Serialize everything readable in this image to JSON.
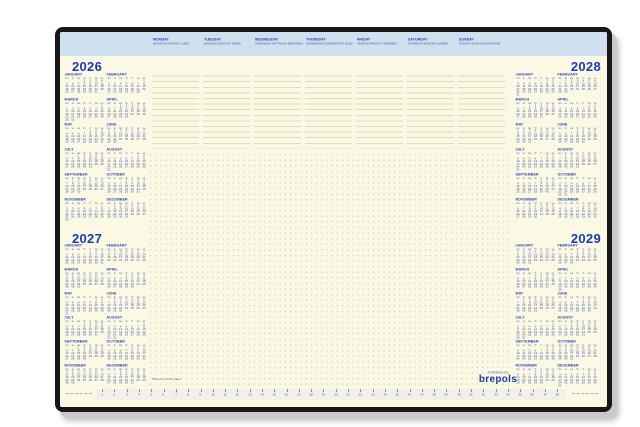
{
  "header": {
    "day_columns": [
      {
        "en": "MONDAY",
        "sub": "MAANDAG MONTAG LUNDI"
      },
      {
        "en": "TUESDAY",
        "sub": "DINSDAG DIENSTAG MARDI"
      },
      {
        "en": "WEDNESDAY",
        "sub": "WOENSDAG MITTWOCH MERCREDI"
      },
      {
        "en": "THURSDAY",
        "sub": "DONDERDAG DONNERSTAG JEUDI"
      },
      {
        "en": "FRIDAY",
        "sub": "VRIJDAG FREITAG VENDREDI"
      },
      {
        "en": "SATURDAY",
        "sub": "ZATERDAG SAMSTAG SAMEDI"
      },
      {
        "en": "SUNDAY",
        "sub": "ZONDAG SONNTAG DIMANCHE"
      }
    ]
  },
  "mini_calendar": {
    "weekday_header": [
      "mo",
      "tu",
      "we",
      "th",
      "fr",
      "sa",
      "su"
    ],
    "month_names": [
      "JANUARY",
      "FEBRUARY",
      "MARCH",
      "APRIL",
      "MAY",
      "JUNE",
      "JULY",
      "AUGUST",
      "SEPTEMBER",
      "OCTOBER",
      "NOVEMBER",
      "DECEMBER"
    ]
  },
  "year_blocks": [
    {
      "year": "2026",
      "side": "left",
      "row": "top"
    },
    {
      "year": "2027",
      "side": "left",
      "row": "bottom"
    },
    {
      "year": "2028",
      "side": "right",
      "row": "top"
    },
    {
      "year": "2029",
      "side": "right",
      "row": "bottom"
    }
  ],
  "footer": {
    "printed_note": "Printed on FSC paper",
    "published_by": "Published by",
    "brand": "brepols",
    "ruler_numbers": [
      1,
      2,
      3,
      4,
      5,
      6,
      7,
      8,
      9,
      10,
      11,
      12,
      13,
      14,
      15,
      16,
      17,
      18,
      19,
      20,
      21,
      22,
      23,
      24,
      25,
      26,
      27,
      28,
      29,
      30,
      31,
      32,
      33,
      34,
      35,
      36,
      37,
      38
    ]
  },
  "colors": {
    "accent_blue": "#1b3bb2",
    "text_blue": "#3053b4",
    "header_band": "#cfe0ee",
    "paper": "#fbf8e4",
    "frame": "#17171a",
    "rule_line": "#dedbbe",
    "dot": "#d9d6b4",
    "ruler_strip": "#f2f1e8"
  }
}
